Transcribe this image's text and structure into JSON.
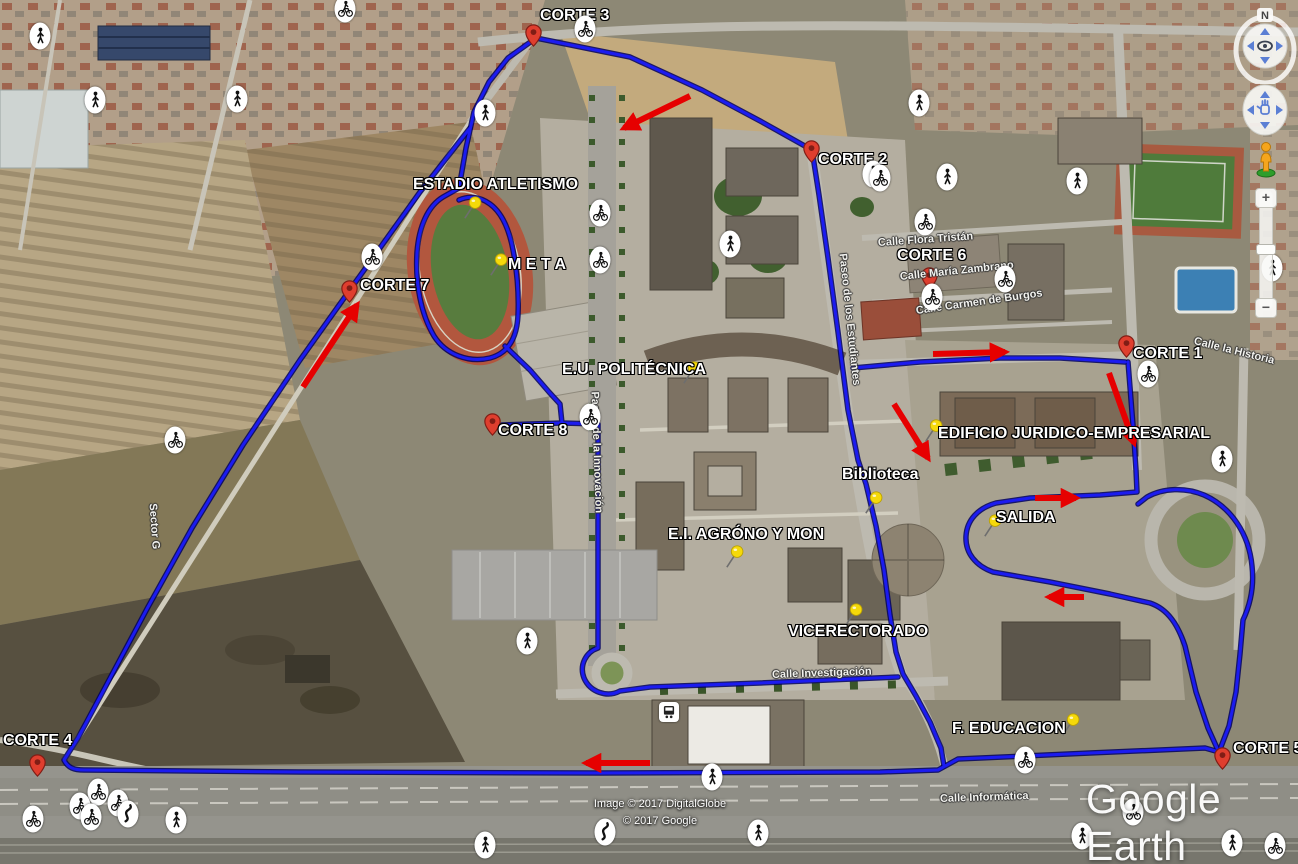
{
  "app": {
    "logo": "Google Earth"
  },
  "attribution": {
    "line1": "Image © 2017 DigitalGlobe",
    "line2": "© 2017 Google"
  },
  "navigation": {
    "north_label": "N",
    "zoom_in_label": "+",
    "zoom_out_label": "−"
  },
  "course": {
    "route_color": "#1b1bf0",
    "arrow_color": "#e60000",
    "segments": [
      "M 536 38 L 630 57 L 702 90 L 762 122 L 812 150 L 819 195 L 828 258 L 838 332 L 848 410 L 858 460 L 866 484 L 876 526 L 884 570 L 890 615 L 896 652 L 903 674 L 916 696 L 930 722 L 941 748 L 944 766",
      "M 536 38 L 508 58 L 489 82 L 474 112 L 466 148 L 459 188 L 443 197 C 428 206 419 226 417 252 C 415 284 421 314 434 336 C 446 355 469 363 490 358 C 509 353 517 337 518 315 C 519 294 517 268 512 245 C 508 227 501 212 490 204 C 479 196 468 196 459 200 M 505 346 L 530 370 L 549 392 L 560 404 L 562 423 L 502 425 M 562 423 L 598 424 L 598 560 L 598 648 C 586 652 579 665 584 678 C 590 692 607 698 620 691 L 650 687 L 760 683 L 898 677",
      "M 470 128 L 420 192 L 352 287 L 300 360 L 243 445 L 192 528 L 148 607 L 108 682 L 78 738 L 64 760 C 68 768 74 770 84 770 L 300 772 L 600 773 L 880 772 L 938 770 L 958 759 L 1090 753 L 1205 748 L 1219 752",
      "M 1219 752 L 1229 726 L 1236 692 L 1240 654 L 1243 620 C 1251 603 1254 584 1252 566 C 1249 534 1231 507 1204 495 C 1185 487 1163 488 1147 497 L 1138 504",
      "M 1128 362 L 1133 425 L 1136 470 L 1137 492 L 1100 495 L 1030 498 L 996 503 C 978 508 967 520 966 536 C 965 553 976 566 993 572 L 1050 582 L 1110 594 L 1150 603 C 1168 609 1178 625 1185 646 L 1196 692 L 1208 728 L 1217 748",
      "M 853 368 L 920 362 L 1000 358 L 1060 358 L 1125 362"
    ],
    "arrows": [
      {
        "x1": 690,
        "y1": 96,
        "x2": 624,
        "y2": 128
      },
      {
        "x1": 303,
        "y1": 387,
        "x2": 357,
        "y2": 305
      },
      {
        "x1": 933,
        "y1": 354,
        "x2": 1005,
        "y2": 352
      },
      {
        "x1": 1109,
        "y1": 373,
        "x2": 1134,
        "y2": 443
      },
      {
        "x1": 894,
        "y1": 404,
        "x2": 928,
        "y2": 458
      },
      {
        "x1": 1035,
        "y1": 498,
        "x2": 1076,
        "y2": 498
      },
      {
        "x1": 1084,
        "y1": 597,
        "x2": 1049,
        "y2": 597
      },
      {
        "x1": 650,
        "y1": 763,
        "x2": 586,
        "y2": 763
      }
    ]
  },
  "checkpoints": [
    {
      "label": "CORTE 1",
      "pin_x": 1126,
      "pin_y": 358,
      "label_x": 1133,
      "label_y": 346
    },
    {
      "label": "CORTE 2",
      "pin_x": 811,
      "pin_y": 163,
      "label_x": 818,
      "label_y": 152
    },
    {
      "label": "CORTE 3",
      "pin_x": 533,
      "pin_y": 47,
      "label_x": 540,
      "label_y": 8
    },
    {
      "label": "CORTE 4",
      "pin_x": 37,
      "pin_y": 777,
      "label_x": 3,
      "label_y": 733
    },
    {
      "label": "CORTE 5",
      "pin_x": 1222,
      "pin_y": 770,
      "label_x": 1233,
      "label_y": 741
    },
    {
      "label": "CORTE 6",
      "pin_x": 929,
      "pin_y": 290,
      "label_x": 897,
      "label_y": 248
    },
    {
      "label": "CORTE 7",
      "pin_x": 349,
      "pin_y": 303,
      "label_x": 360,
      "label_y": 278
    },
    {
      "label": "CORTE 8",
      "pin_x": 492,
      "pin_y": 436,
      "label_x": 498,
      "label_y": 423
    }
  ],
  "places": [
    {
      "label": "ESTADIO ATLETISMO",
      "pin_x": 465,
      "pin_y": 219,
      "label_x": 413,
      "label_y": 177
    },
    {
      "label": "M E T A",
      "pin_x": 491,
      "pin_y": 276,
      "label_x": 508,
      "label_y": 257
    },
    {
      "label": "E.U. POLITÉCNICA",
      "pin_x": 684,
      "pin_y": 384,
      "label_x": 562,
      "label_y": 362
    },
    {
      "label": "EDIFICIO JURIDICO-EMPRESARIAL",
      "pin_x": 926,
      "pin_y": 442,
      "label_x": 938,
      "label_y": 426
    },
    {
      "label": "Biblioteca",
      "pin_x": 866,
      "pin_y": 514,
      "label_x": 842,
      "label_y": 467
    },
    {
      "label": "SALIDA",
      "pin_x": 985,
      "pin_y": 537,
      "label_x": 996,
      "label_y": 510
    },
    {
      "label": "E.I. AGRÓNO Y MON",
      "pin_x": 727,
      "pin_y": 568,
      "label_x": 668,
      "label_y": 527
    },
    {
      "label": "VICERECTORADO",
      "pin_x": 846,
      "pin_y": 626,
      "label_x": 788,
      "label_y": 624
    },
    {
      "label": "F. EDUCACION",
      "pin_x": 1063,
      "pin_y": 736,
      "label_x": 952,
      "label_y": 721
    }
  ],
  "street_labels": [
    {
      "text": "Calle Flora Tristán",
      "x": 878,
      "y": 238,
      "rotation": -4
    },
    {
      "text": "Calle María Zambrano",
      "x": 900,
      "y": 272,
      "rotation": -6
    },
    {
      "text": "Calle Carmen de Burgos",
      "x": 916,
      "y": 306,
      "rotation": -8
    },
    {
      "text": "Calle la Historia",
      "x": 1194,
      "y": 336,
      "rotation": 14
    },
    {
      "text": "Paseo de los Estudiantes",
      "x": 842,
      "y": 248,
      "rotation": 84
    },
    {
      "text": "Paseo de la Innovación",
      "x": 594,
      "y": 386,
      "rotation": 88
    },
    {
      "text": "Sector G",
      "x": 152,
      "y": 498,
      "rotation": 86
    },
    {
      "text": "Calle Investigación",
      "x": 772,
      "y": 670,
      "rotation": -2
    },
    {
      "text": "Calle Informática",
      "x": 940,
      "y": 794,
      "rotation": -2
    }
  ],
  "activity_icons": [
    {
      "type": "pedestrian",
      "x": 40,
      "y": 36
    },
    {
      "type": "pedestrian",
      "x": 95,
      "y": 100
    },
    {
      "type": "pedestrian",
      "x": 237,
      "y": 99
    },
    {
      "type": "pedestrian",
      "x": 485,
      "y": 113
    },
    {
      "type": "pedestrian",
      "x": 919,
      "y": 103
    },
    {
      "type": "pedestrian",
      "x": 873,
      "y": 174
    },
    {
      "type": "pedestrian",
      "x": 947,
      "y": 177
    },
    {
      "type": "pedestrian",
      "x": 1077,
      "y": 181
    },
    {
      "type": "pedestrian",
      "x": 730,
      "y": 244
    },
    {
      "type": "pedestrian",
      "x": 1272,
      "y": 268
    },
    {
      "type": "pedestrian",
      "x": 1222,
      "y": 459
    },
    {
      "type": "pedestrian",
      "x": 527,
      "y": 641
    },
    {
      "type": "pedestrian",
      "x": 712,
      "y": 777
    },
    {
      "type": "pedestrian",
      "x": 758,
      "y": 833
    },
    {
      "type": "pedestrian",
      "x": 485,
      "y": 845
    },
    {
      "type": "pedestrian",
      "x": 176,
      "y": 820
    },
    {
      "type": "pedestrian",
      "x": 1082,
      "y": 836
    },
    {
      "type": "pedestrian",
      "x": 1232,
      "y": 843
    },
    {
      "type": "cyclist",
      "x": 345,
      "y": 9
    },
    {
      "type": "cyclist",
      "x": 585,
      "y": 29
    },
    {
      "type": "cyclist",
      "x": 600,
      "y": 213
    },
    {
      "type": "cyclist",
      "x": 600,
      "y": 260
    },
    {
      "type": "cyclist",
      "x": 880,
      "y": 178
    },
    {
      "type": "cyclist",
      "x": 925,
      "y": 222
    },
    {
      "type": "cyclist",
      "x": 932,
      "y": 297
    },
    {
      "type": "cyclist",
      "x": 1005,
      "y": 279
    },
    {
      "type": "cyclist",
      "x": 372,
      "y": 257
    },
    {
      "type": "cyclist",
      "x": 1148,
      "y": 374
    },
    {
      "type": "cyclist",
      "x": 590,
      "y": 417
    },
    {
      "type": "cyclist",
      "x": 175,
      "y": 440
    },
    {
      "type": "cyclist",
      "x": 1025,
      "y": 760
    },
    {
      "type": "cyclist",
      "x": 98,
      "y": 792
    },
    {
      "type": "cyclist",
      "x": 80,
      "y": 806
    },
    {
      "type": "cyclist",
      "x": 118,
      "y": 803
    },
    {
      "type": "cyclist",
      "x": 91,
      "y": 817
    },
    {
      "type": "cyclist",
      "x": 33,
      "y": 819
    },
    {
      "type": "cyclist",
      "x": 1133,
      "y": 812
    },
    {
      "type": "cyclist",
      "x": 1275,
      "y": 846
    },
    {
      "type": "winding-road",
      "x": 128,
      "y": 814
    },
    {
      "type": "winding-road",
      "x": 605,
      "y": 832
    },
    {
      "type": "transit",
      "x": 669,
      "y": 712
    }
  ]
}
